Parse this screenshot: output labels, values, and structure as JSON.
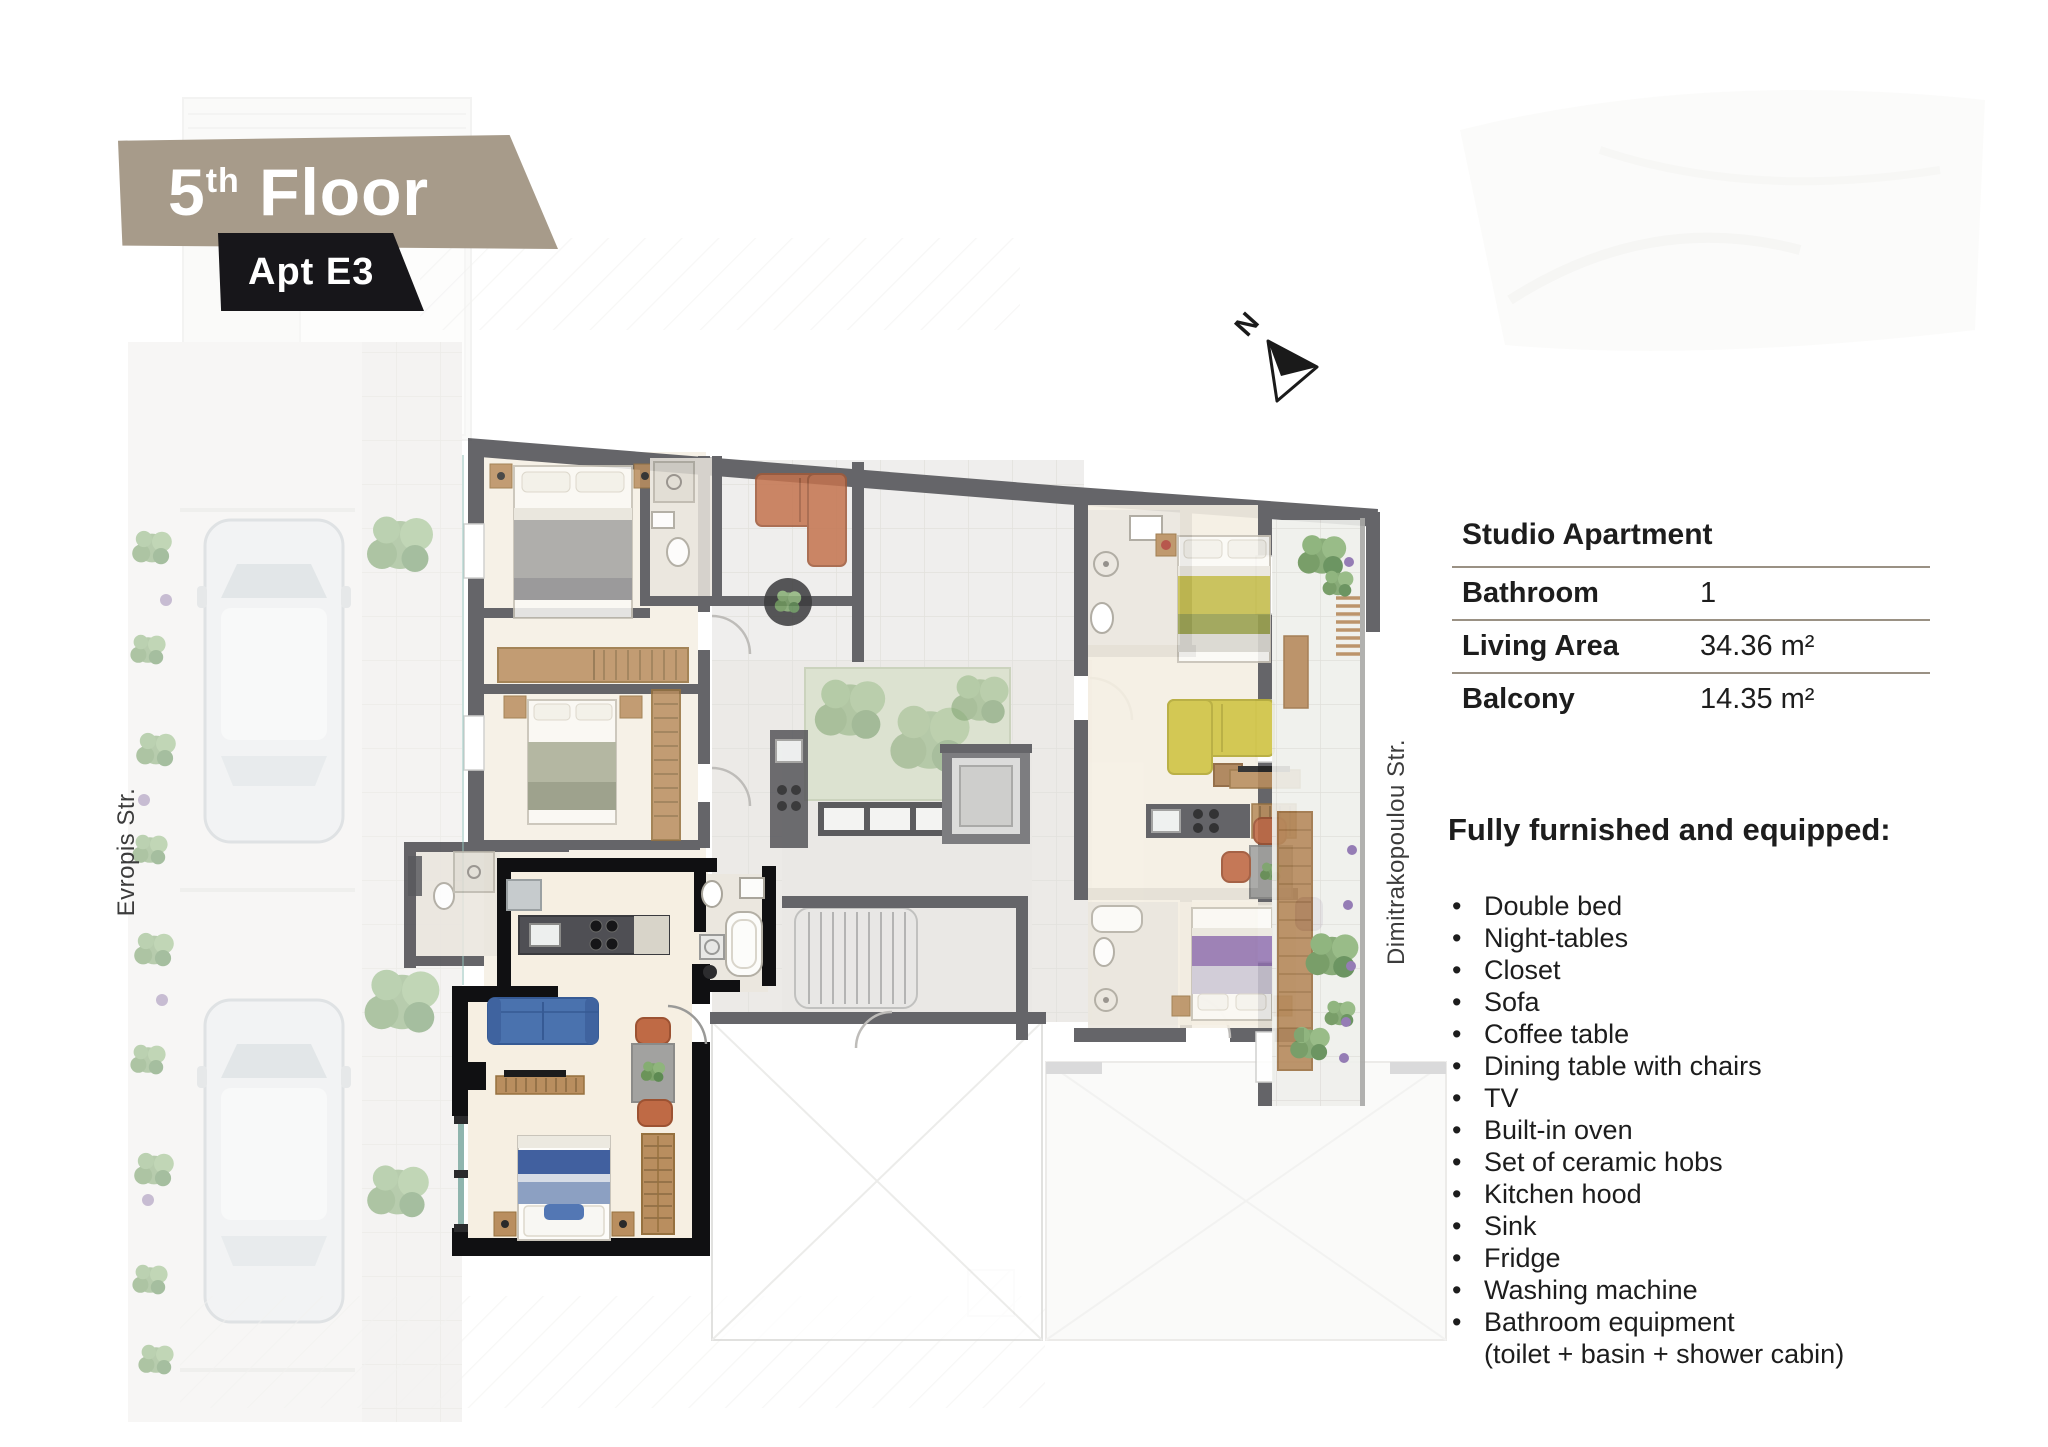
{
  "banner": {
    "floor_number": "5",
    "floor_ordinal": "th",
    "floor_word": " Floor",
    "apt": "Apt E3"
  },
  "compass": {
    "north": "N"
  },
  "streets": {
    "left": "Evropis Str.",
    "right": "Dimitrakopoulou Str."
  },
  "details": {
    "title": "Studio Apartment",
    "rows": [
      {
        "label": "Bathroom",
        "value": "1"
      },
      {
        "label": "Living Area",
        "value": "34.36 m²"
      },
      {
        "label": "Balcony",
        "value": "14.35 m²"
      }
    ]
  },
  "features": {
    "heading": "Fully furnished and equipped:",
    "bullet": "•",
    "items": [
      "Double bed",
      "Night-tables",
      "Closet",
      "Sofa",
      "Coffee table",
      "Dining table with chairs",
      "TV",
      "Built-in oven",
      "Set of ceramic hobs",
      "Kitchen hood",
      "Sink",
      "Fridge",
      "Washing machine",
      "Bathroom equipment"
    ],
    "continuation": "(toilet + basin + shower cabin)"
  },
  "colors": {
    "banner-tan": "#a79b8a",
    "banner-dark": "#17161a",
    "text": "#1d1d1d",
    "rule": "#9a9184",
    "wall": "#4b4b4f",
    "wall-e3": "#101012",
    "accent-blue": "#4a72ae",
    "accent-yellow": "#cfc342",
    "accent-orange": "#c4734e",
    "accent-purple": "#8f6fae"
  }
}
